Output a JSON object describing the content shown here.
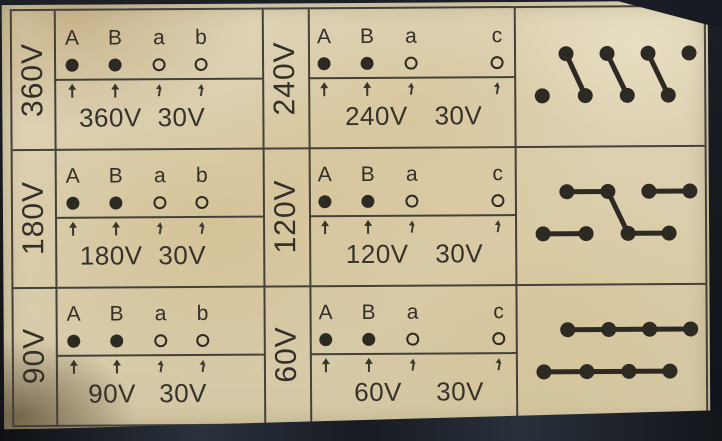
{
  "palette": {
    "paper": "#ddd2b4",
    "ink": "#36332c",
    "photo_edge": "#171a20"
  },
  "panel": {
    "description": "Transformer tap connection label: six voltage cells with terminal marks and three winding connection diagrams",
    "secondary_common": "30V",
    "rows": [
      {
        "left": {
          "label": "360V",
          "terminals": [
            {
              "name": "A",
              "type": "filled"
            },
            {
              "name": "B",
              "type": "filled"
            },
            {
              "name": "a",
              "type": "open"
            },
            {
              "name": "b",
              "type": "open"
            }
          ],
          "primary": "360V",
          "secondary": "30V"
        },
        "mid": {
          "label": "240V",
          "terminals": [
            {
              "name": "A",
              "type": "filled"
            },
            {
              "name": "B",
              "type": "filled"
            },
            {
              "name": "a",
              "type": "open"
            },
            {
              "name": "c",
              "type": "open"
            }
          ],
          "primary": "240V",
          "secondary": "30V"
        },
        "diagram": {
          "top_dots": 4,
          "bottom_dots": 4,
          "links": [
            [
              "t0",
              "b1"
            ],
            [
              "t1",
              "b2"
            ],
            [
              "t2",
              "b3"
            ]
          ]
        }
      },
      {
        "left": {
          "label": "180V",
          "terminals": [
            {
              "name": "A",
              "type": "filled"
            },
            {
              "name": "B",
              "type": "filled"
            },
            {
              "name": "a",
              "type": "open"
            },
            {
              "name": "b",
              "type": "open"
            }
          ],
          "primary": "180V",
          "secondary": "30V"
        },
        "mid": {
          "label": "120V",
          "terminals": [
            {
              "name": "A",
              "type": "filled"
            },
            {
              "name": "B",
              "type": "filled"
            },
            {
              "name": "a",
              "type": "open"
            },
            {
              "name": "c",
              "type": "open"
            }
          ],
          "primary": "120V",
          "secondary": "30V"
        },
        "diagram": {
          "top_dots": 4,
          "bottom_dots": 4,
          "links": [
            [
              "t0",
              "t1"
            ],
            [
              "t2",
              "t3"
            ],
            [
              "b0",
              "b1"
            ],
            [
              "b2",
              "b3"
            ],
            [
              "t1",
              "b2"
            ]
          ]
        }
      },
      {
        "left": {
          "label": "90V",
          "terminals": [
            {
              "name": "A",
              "type": "filled"
            },
            {
              "name": "B",
              "type": "filled"
            },
            {
              "name": "a",
              "type": "open"
            },
            {
              "name": "b",
              "type": "open"
            }
          ],
          "primary": "90V",
          "secondary": "30V"
        },
        "mid": {
          "label": "60V",
          "terminals": [
            {
              "name": "A",
              "type": "filled"
            },
            {
              "name": "B",
              "type": "filled"
            },
            {
              "name": "a",
              "type": "open"
            },
            {
              "name": "c",
              "type": "open"
            }
          ],
          "primary": "60V",
          "secondary": "30V"
        },
        "diagram": {
          "top_dots": 4,
          "bottom_dots": 4,
          "links": [
            [
              "t0",
              "t1"
            ],
            [
              "t1",
              "t2"
            ],
            [
              "t2",
              "t3"
            ],
            [
              "b0",
              "b1"
            ],
            [
              "b1",
              "b2"
            ],
            [
              "b2",
              "b3"
            ]
          ]
        }
      }
    ]
  }
}
